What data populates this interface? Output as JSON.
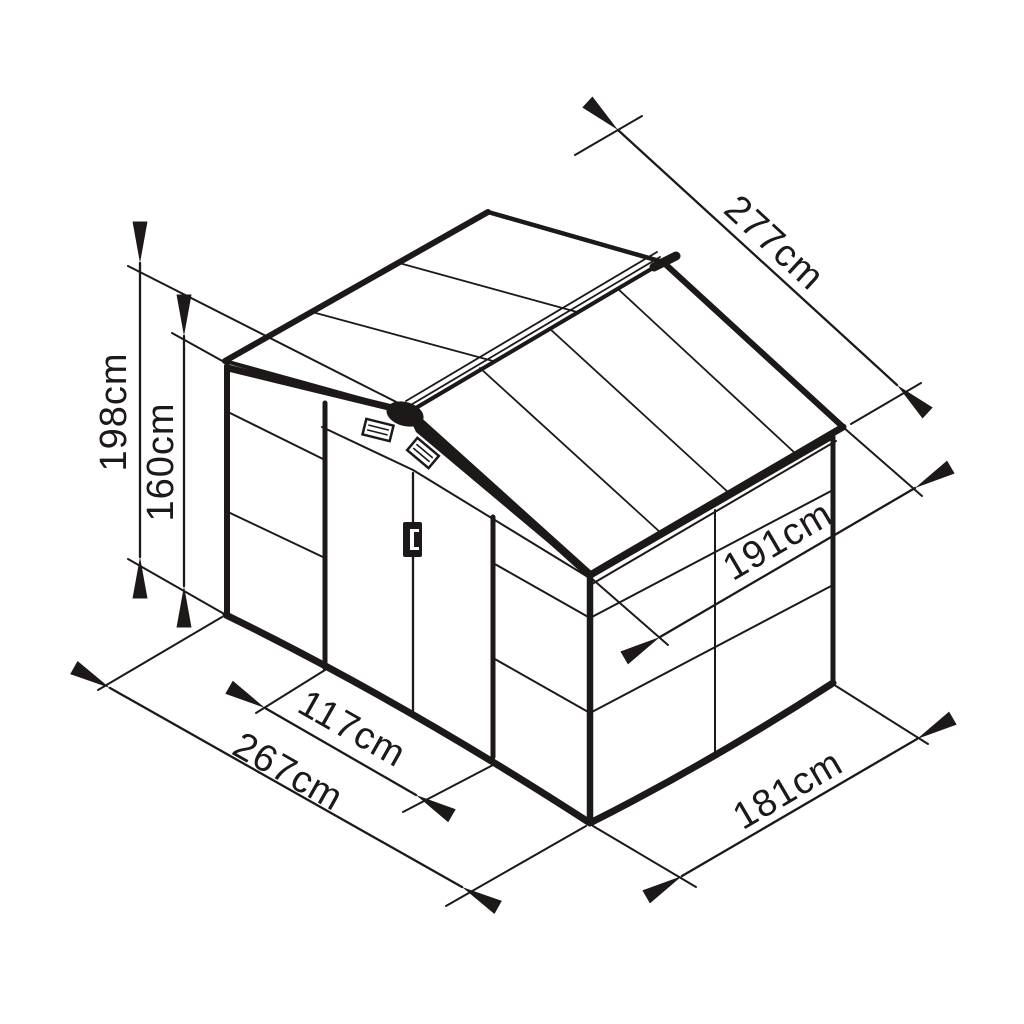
{
  "diagram": {
    "subject": "isometric garden shed technical drawing with dimension annotations",
    "background": "#ffffff",
    "line_color": "#1c1918",
    "unit": "cm",
    "dimensions": {
      "ridge_height": "198cm",
      "wall_height": "160cm",
      "roof_length": "277cm",
      "roof_depth": "191cm",
      "door_width": "117cm",
      "base_width": "267cm",
      "base_depth": "181cm"
    }
  }
}
